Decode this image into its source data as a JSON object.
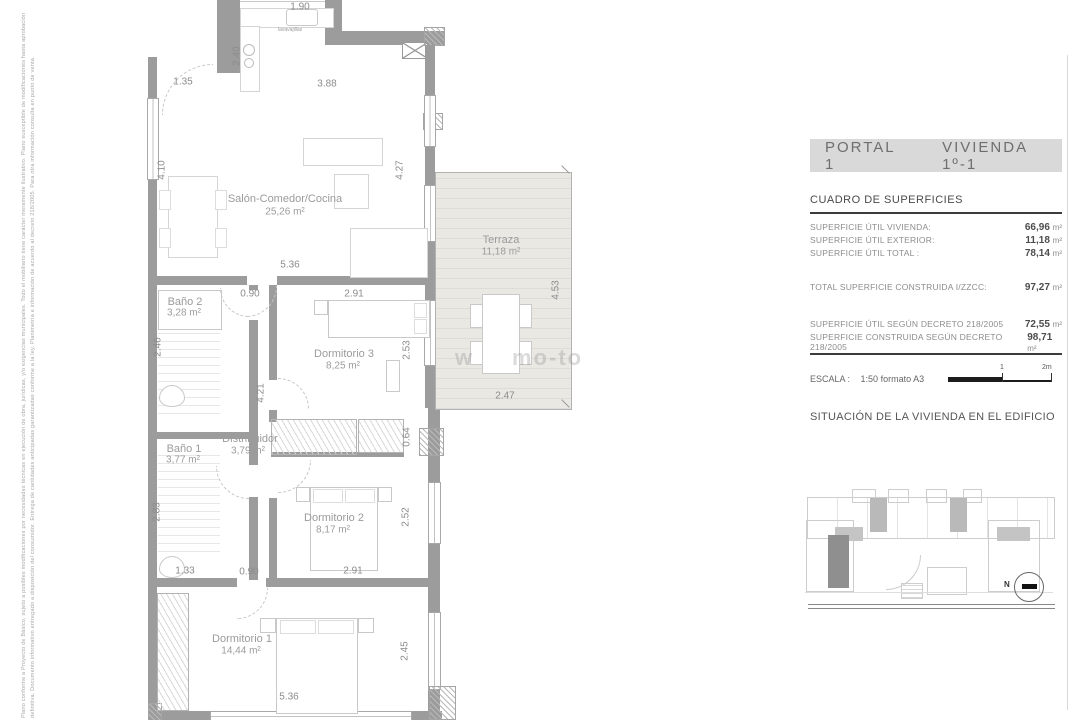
{
  "panel": {
    "portal": "PORTAL 1",
    "vivienda": "VIVIENDA 1º-1",
    "table_title": "CUADRO DE SUPERFICIES",
    "rows": [
      {
        "label": "SUPERFICIE ÚTIL VIVIENDA:",
        "value": "66,96",
        "unit": "m²"
      },
      {
        "label": "SUPERFICIE ÚTIL EXTERIOR:",
        "value": "11,18",
        "unit": "m²"
      },
      {
        "label": "SUPERFICIE ÚTIL TOTAL :",
        "value": "78,14",
        "unit": "m²"
      },
      {
        "label": "TOTAL SUPERFICIE CONSTRUIDA I/ZZCC:",
        "value": "97,27",
        "unit": "m²"
      },
      {
        "label": "SUPERFICIE ÚTIL SEGÚN DECRETO 218/2005",
        "value": "72,55",
        "unit": "m²"
      },
      {
        "label": "SUPERFICIE CONSTRUIDA SEGÚN DECRETO 218/2005",
        "value": "98,71",
        "unit": "m²"
      }
    ],
    "scale_label": "ESCALA :",
    "scale_value": "1:50 formato A3",
    "scale_tick_mid": "1",
    "scale_tick_end": "2m",
    "situacion_title": "SITUACIÓN DE LA VIVIENDA EN EL EDIFICIO",
    "north_label": "N"
  },
  "plan": {
    "rooms": {
      "salon": {
        "name": "Salón-Comedor/Cocina",
        "area": "25,26 m²"
      },
      "terraza": {
        "name": "Terraza",
        "area": "11,18 m²"
      },
      "bano2": {
        "name": "Baño 2",
        "area": "3,28 m²"
      },
      "dorm3": {
        "name": "Dormitorio 3",
        "area": "8,25 m²"
      },
      "distribuidor": {
        "name": "Distribuidor",
        "area": "3,79 m²"
      },
      "bano1": {
        "name": "Baño 1",
        "area": "3,77 m²"
      },
      "dorm2": {
        "name": "Dormitorio 2",
        "area": "8,17 m²"
      },
      "dorm1": {
        "name": "Dormitorio 1",
        "area": "14,44 m²"
      }
    },
    "dims": {
      "kitchen_top": "1.90",
      "kitchen_depth": "2.40",
      "entry": "1.35",
      "kitchen_w": "3.88",
      "salon_left_h": "4.10",
      "salon_right_h": "4.27",
      "salon_w": "5.36",
      "hall_door": "0.90",
      "dorm3_w": "2.91",
      "bano2_h": "2.46",
      "dorm3_h": "2.53",
      "hall_h": "4.21",
      "terraza_h": "4.53",
      "terraza_w": "2.47",
      "closet_d": "0.64",
      "bano1_h": "2.83",
      "dorm2_h": "2.52",
      "bano1_w": "1.33",
      "dorm1_door": "0.90",
      "dorm2_w": "2.91",
      "dorm1_side": "2.45",
      "dorm1_w": "5.36"
    },
    "kitchen_label": "lavavajillas",
    "watermark_a": "w",
    "watermark_b": "mo-to"
  },
  "disclaimer": {
    "line1": "Plano conforme a Proyecto de Básico, sujeto a posibles modificaciones por necesidades técnicas en ejecución de obra, jurídicas, y/o exigencias municipales. Todo el mobiliario tiene carácter meramente ilustrativo. Plano susceptible de modificaciones hasta aprobación",
    "line2": "definitiva. Documento informativo entregado a disposición del consumidor. Entrega de cantidades anticipadas garantizadas conforme a la ley. Planimetría e información de acuerdo al decreto 218/2005. Para otra información consulta en punto de venta."
  }
}
